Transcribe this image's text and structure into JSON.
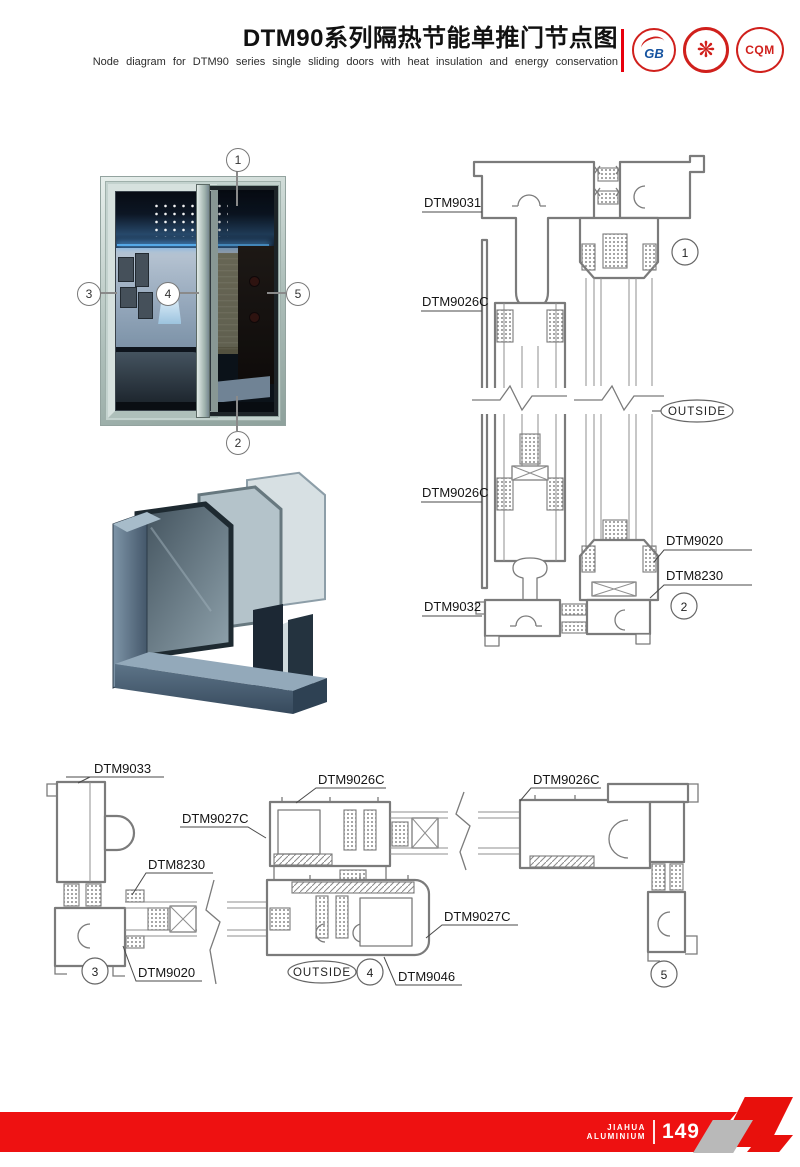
{
  "header": {
    "title_cn": "DTM90系列隔热节能单推门节点图",
    "title_en": "Node diagram for DTM90 series single sliding doors with heat insulation and energy conservation",
    "logos": [
      {
        "name": "gb-certification",
        "text": "GB"
      },
      {
        "name": "quality-emblem",
        "text": "❋"
      },
      {
        "name": "cqm-certification",
        "text": "CQM"
      }
    ]
  },
  "photo_figure": {
    "callouts": [
      "1",
      "2",
      "3",
      "4",
      "5"
    ]
  },
  "vertical_section": {
    "label_top_frame": "DTM9031",
    "label_interlock_upper": "DTM9026C",
    "label_interlock_lower": "DTM9026C",
    "label_bottom_frame": "DTM9032",
    "label_glazing_bead": "DTM9020",
    "label_corner_gasket": "DTM8230",
    "outside": "OUTSIDE",
    "callout_top": "1",
    "callout_bottom": "2"
  },
  "horizontal_section": {
    "label_left_jamb": "DTM9033",
    "label_interlock_left": "DTM9026C",
    "label_interlock_right": "DTM9026C",
    "label_sash_upper": "DTM9027C",
    "label_gasket": "DTM8230",
    "label_glazing_bead": "DTM9020",
    "label_sash_lower": "DTM9027C",
    "label_sash_bottom": "DTM9046",
    "outside": "OUTSIDE",
    "callout_left": "3",
    "callout_middle": "4",
    "callout_right": "5"
  },
  "footer": {
    "brand_line1": "JIAHUA",
    "brand_line2": "ALUMINIUM",
    "page_number": "149"
  },
  "colors": {
    "accent_red": "#e8000d",
    "drawing_gray": "#7b7b7b"
  }
}
